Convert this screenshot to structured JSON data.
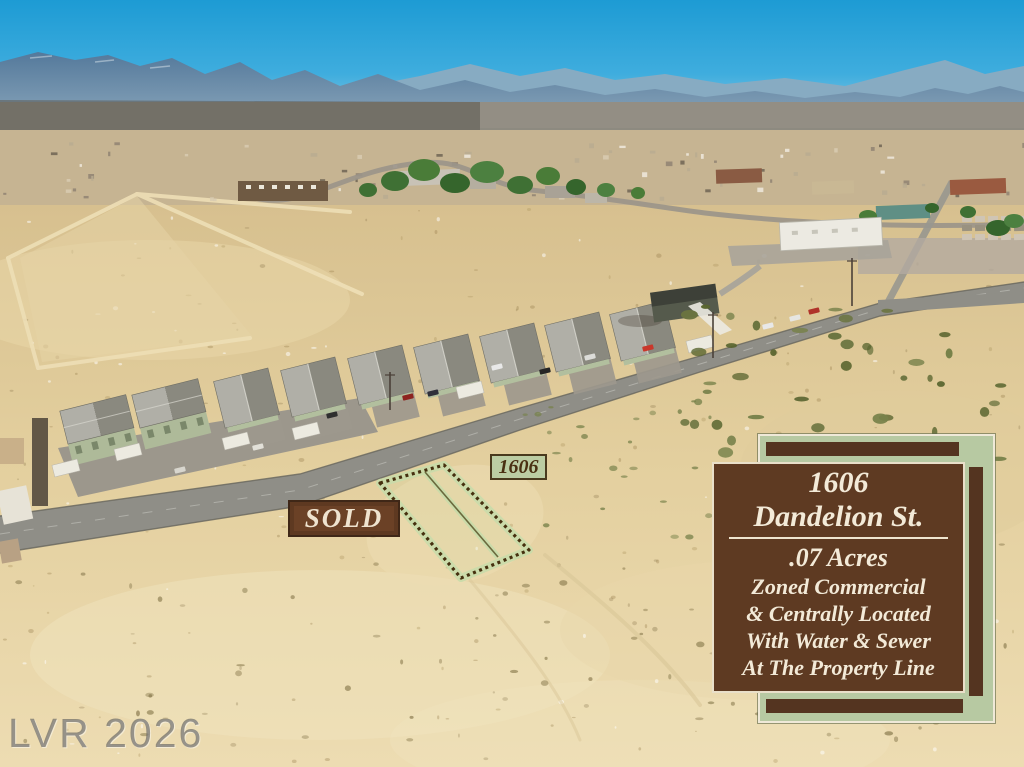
{
  "scene": {
    "description": "Aerial drone photo of a desert town: vacant dirt land in the foreground, a dashed-outlined vacant parcel beside a diagonal paved street, a row of single-story houses with gray roofs along the street, scattered commercial buildings and trees in the midground, and blue mountain ranges under a clear cyan sky on the horizon"
  },
  "overlays": {
    "watermark": "LVR 2026",
    "sold_tag": "SOLD",
    "parcel_tag": "1606",
    "info_card": {
      "address_line1": "1606",
      "address_line2": "Dandelion St.",
      "details": [
        ".07 Acres",
        "Zoned Commercial",
        "& Centrally Located",
        "With Water & Sewer",
        "At The Property Line"
      ]
    }
  },
  "colors": {
    "card_brown": "#5e3a22",
    "card_cream_text": "#f3ead8",
    "sage_green_panel": "#b7c9a2",
    "tag_text_brown": "#4a3012",
    "sold_box_brown": "#6b4126",
    "sky_blue": "#1d9bd4",
    "desert_tan": "#e3cf9e",
    "parcel_outline_brown": "#46300f",
    "parcel_glow_green": "#c9dcaa"
  }
}
